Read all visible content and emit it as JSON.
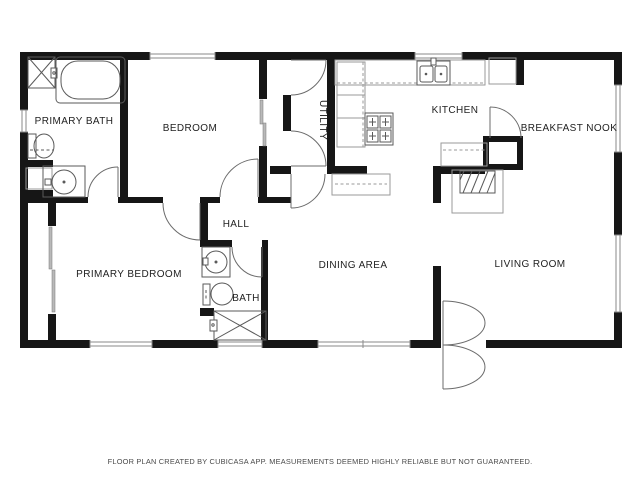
{
  "rooms": [
    {
      "id": "primary-bath",
      "label": "PRIMARY BATH"
    },
    {
      "id": "bedroom",
      "label": "BEDROOM"
    },
    {
      "id": "utility",
      "label": "UTILITY"
    },
    {
      "id": "kitchen",
      "label": "KITCHEN"
    },
    {
      "id": "breakfast-nook",
      "label": "BREAKFAST NOOK"
    },
    {
      "id": "hall",
      "label": "HALL"
    },
    {
      "id": "primary-bedroom",
      "label": "PRIMARY BEDROOM"
    },
    {
      "id": "bath",
      "label": "BATH"
    },
    {
      "id": "dining-area",
      "label": "DINING AREA"
    },
    {
      "id": "living-room",
      "label": "LIVING ROOM"
    }
  ],
  "footer": {
    "text": "FLOOR PLAN CREATED BY CUBICASA APP. MEASUREMENTS DEEMED HIGHLY RELIABLE BUT NOT GUARANTEED."
  },
  "fixtures": [
    "shower",
    "bathtub",
    "toilet",
    "vanity-sink",
    "linen-closet",
    "closet-slider",
    "washer-area-counters",
    "kitchen-sink",
    "stove",
    "refrigerator",
    "pantry",
    "fireplace",
    "bar-counter",
    "hall-bath-sink",
    "hall-bath-toilet",
    "hall-bath-shower",
    "front-door"
  ],
  "colors": {
    "wall": "#161616",
    "fixture_outline": "#5a5a5a",
    "light_outline": "#9a9a9a",
    "window": "#8a8a8a",
    "background": "#ffffff",
    "text": "#222222"
  }
}
